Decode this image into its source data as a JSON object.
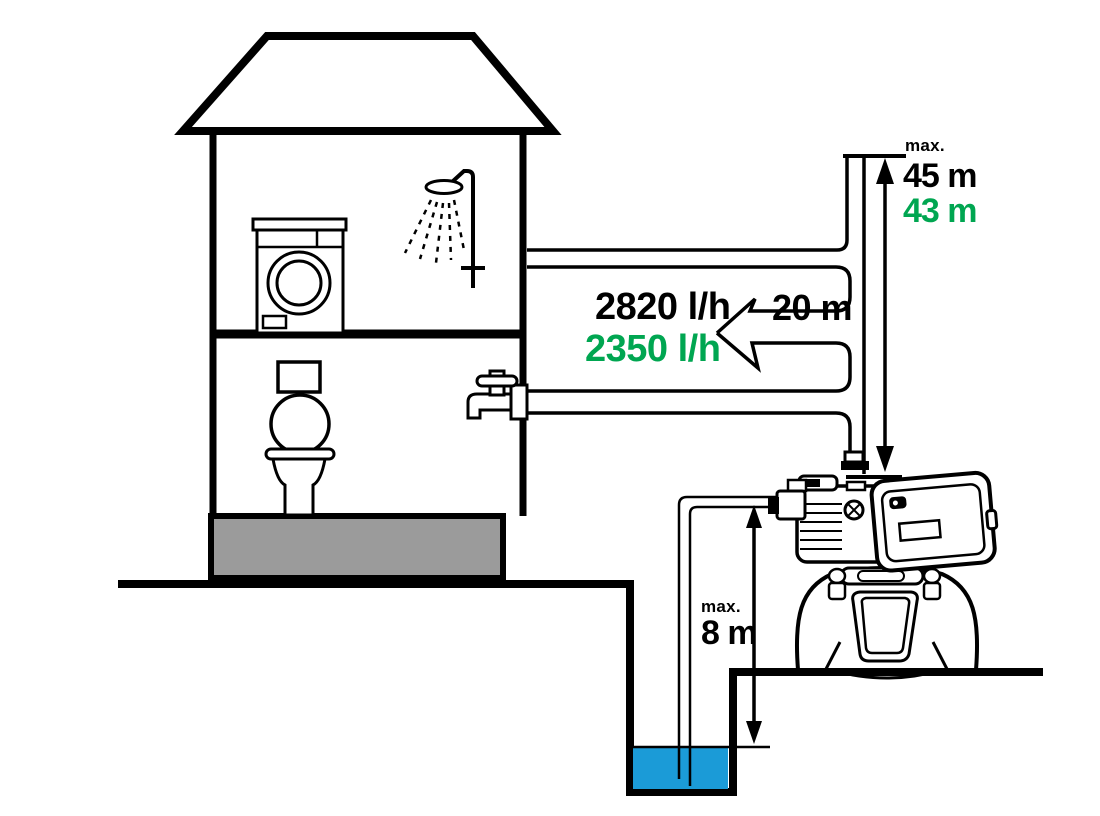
{
  "diagram": {
    "labels": {
      "head_max_caption": "max.",
      "head_black": "45 m",
      "head_green": "43 m",
      "flow_black": "2820 l/h",
      "flow_green": "2350 l/h",
      "distance": "20 m",
      "suction_max_caption": "max.",
      "suction_depth": "8 m"
    },
    "colors": {
      "green": "#00a651",
      "water_blue": "#1b9bd7",
      "foundation_gray": "#9b9b9b",
      "line": "#000000"
    }
  }
}
